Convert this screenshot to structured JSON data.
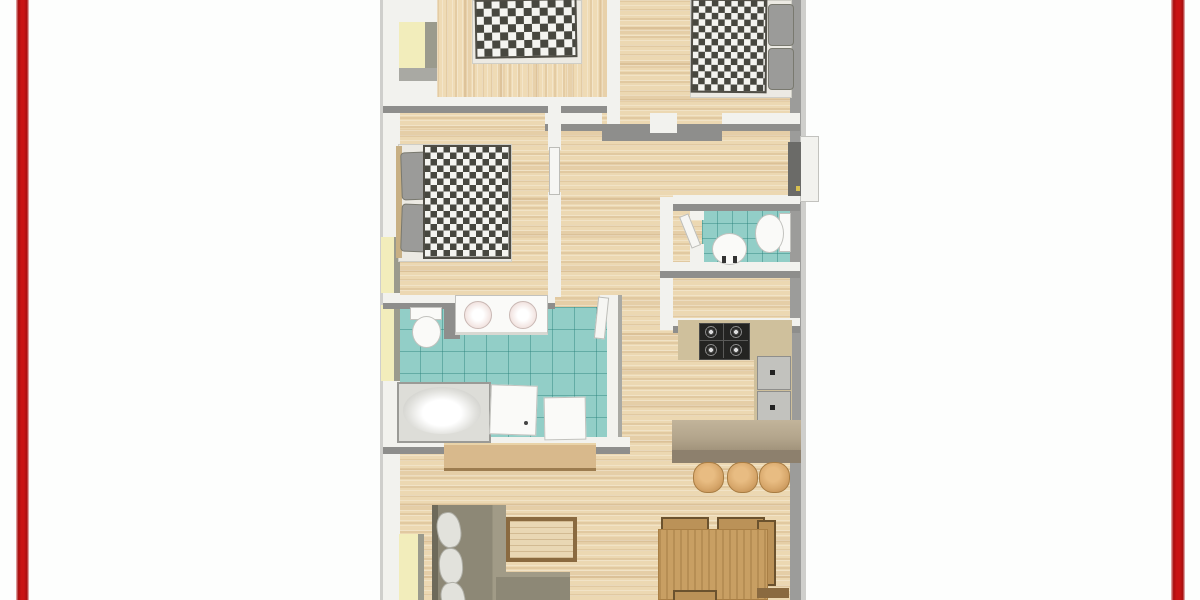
{
  "meta": {
    "description": "3D-rendered top-down apartment floor plan framed by two vertical red bars on a white page",
    "image_width": 1200,
    "image_height": 600,
    "visible_text": []
  },
  "palette": {
    "page_bg": "#fdfefd",
    "frame_red": "#c91414",
    "wall_white": "#f2f2ee",
    "wall_shadow": "#8e8e8c",
    "wall_outer": "#cfcfcc",
    "wood_light": "#ecd8b2",
    "tile_teal": "#92cec7",
    "duvet_dark": "#47473f",
    "duvet_light": "#f4f4f0",
    "pillow_gray": "#9b9b99",
    "counter_tan": "#cfc09c",
    "bar_tan": "#b3a58c",
    "bar_front": "#8d806d",
    "stool_wood": "#d8a86c",
    "table_wood": "#c89f63",
    "sofa_olive": "#8d8876",
    "sideboard_wood": "#d8b98c",
    "window_sill": "#f2edbb",
    "window_frame": "#9b9b8d",
    "stove_black": "#242422",
    "fixture_white": "#fafaf8",
    "door_dark": "#6b6b68"
  },
  "scene": {
    "frame": [
      "left-red-bar",
      "right-red-bar"
    ],
    "rooms": [
      "bedroom-top-left",
      "bedroom-top-right",
      "bedroom-middle-left",
      "bathroom",
      "wc",
      "hallway",
      "kitchen",
      "living-dining-area"
    ],
    "furniture": [
      "double-bed-checkered-duvet-1",
      "double-bed-checkered-duvet-2",
      "double-bed-checkered-duvet-3",
      "toilet-bathroom",
      "double-sink-vanity",
      "bathtub",
      "shower",
      "appliance-box",
      "toilet-wc",
      "wash-basin",
      "gas-stove",
      "kitchen-counter",
      "kitchen-sink-unit",
      "breakfast-bar",
      "bar-stool-1",
      "bar-stool-2",
      "bar-stool-3",
      "sideboard",
      "corner-sofa",
      "sofa-pillows",
      "coffee-table",
      "dining-table",
      "dining-chair-1",
      "dining-chair-2",
      "dining-chair-3",
      "dining-chair-4",
      "entry-door",
      "interior-door-leaves",
      "windows-with-yellow-sills"
    ]
  }
}
